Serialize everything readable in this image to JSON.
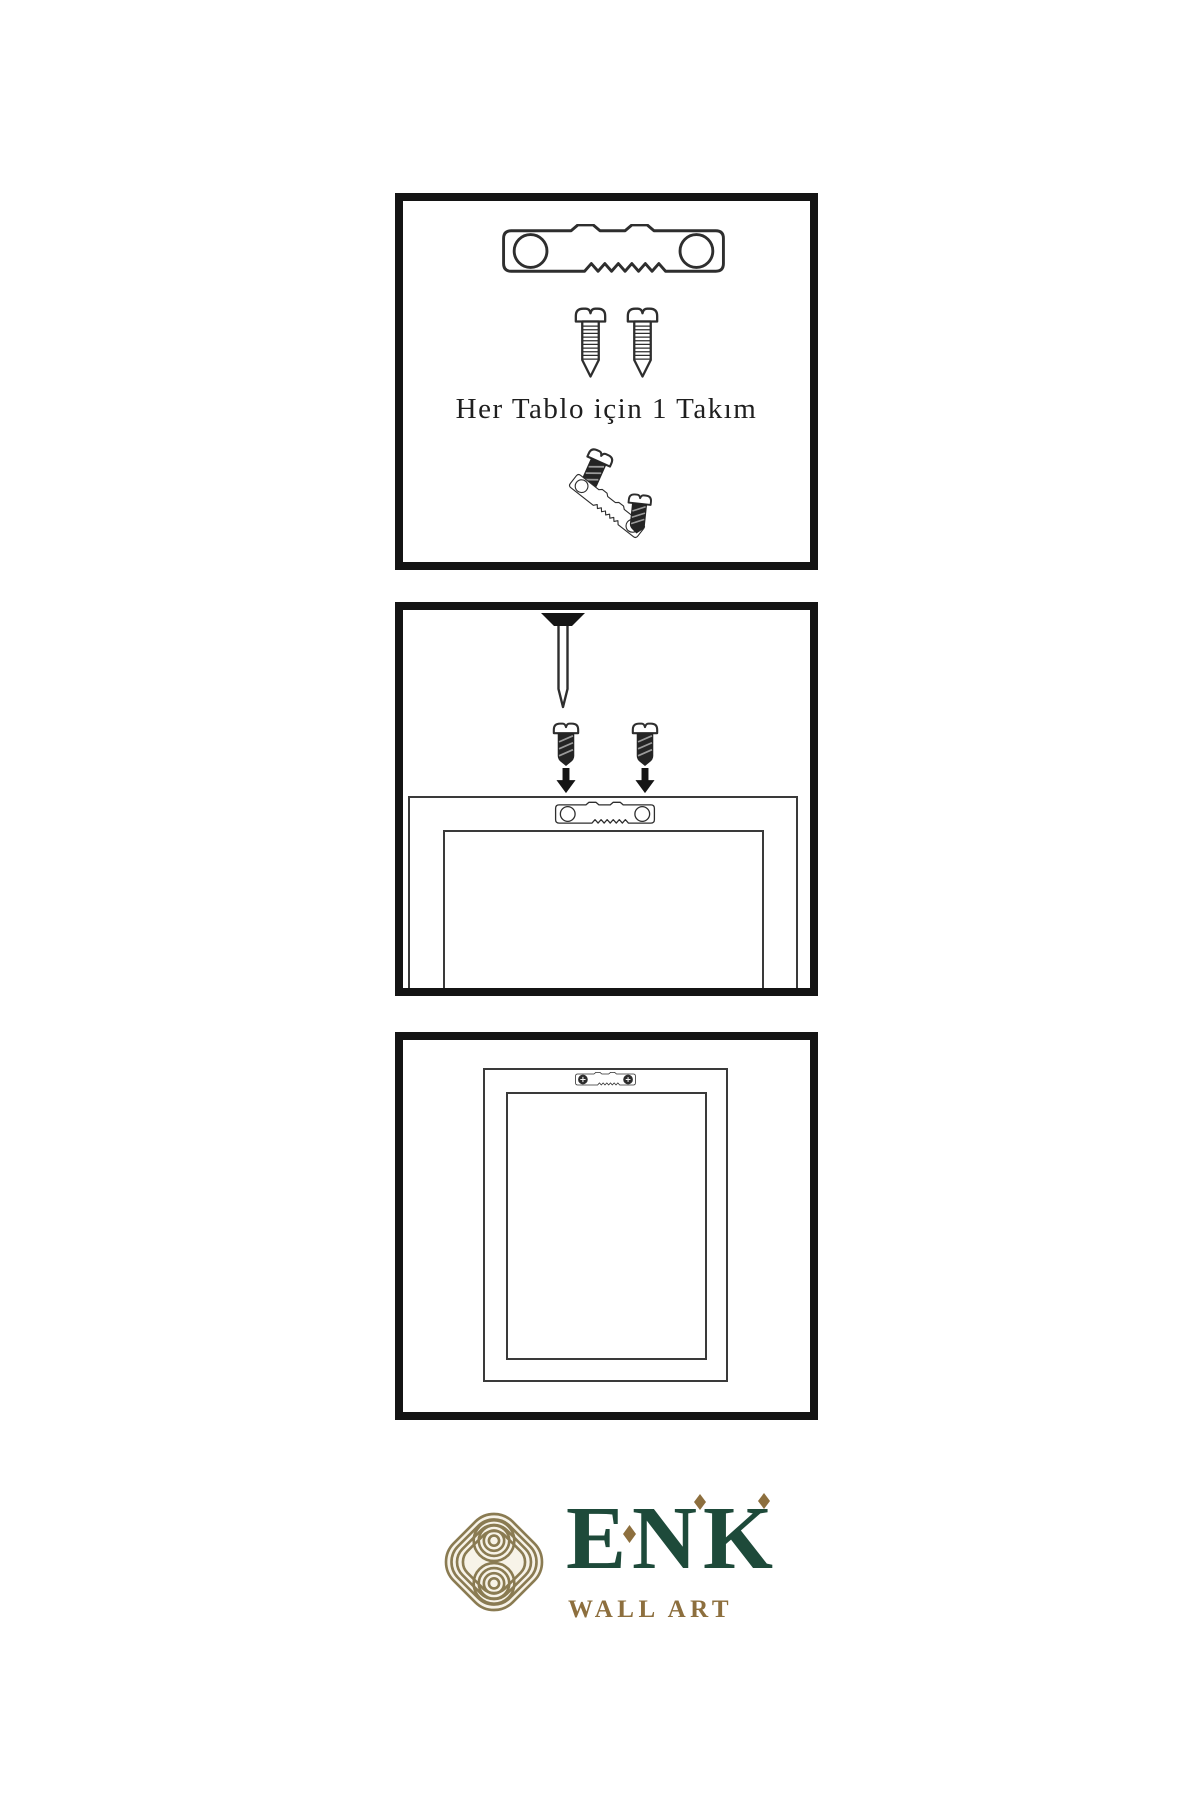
{
  "page": {
    "width": 1200,
    "height": 1800,
    "background": "#ffffff"
  },
  "colors": {
    "panel_border": "#141414",
    "hardware_outline": "#2e2e2e",
    "hardware_dark_fill": "#1f1f1f",
    "frame_line": "#3a3a3a",
    "brand_green": "#1e4a3a",
    "brand_gold": "#8d6f3e",
    "knot_gold": "#8a7b52",
    "knot_background": "#f7f3e8"
  },
  "panels": [
    {
      "id": "hardware-kit",
      "caption": "Her Tablo için 1 Takım",
      "items": [
        "sawtooth-hanger",
        "mounting-screw",
        "mounting-screw",
        "hanger-screw-assembly"
      ]
    },
    {
      "id": "wall-mounting",
      "items": [
        "wall-nail",
        "screw-with-down-arrow",
        "screw-with-down-arrow",
        "sawtooth-hanger-on-frame-back",
        "frame-back"
      ]
    },
    {
      "id": "mounted-frame",
      "items": [
        "frame-back",
        "installed-sawtooth-hanger"
      ]
    }
  ],
  "brand": {
    "name": "ENK",
    "tagline": "WALL ART",
    "logo": "interlaced-knot-emblem"
  }
}
